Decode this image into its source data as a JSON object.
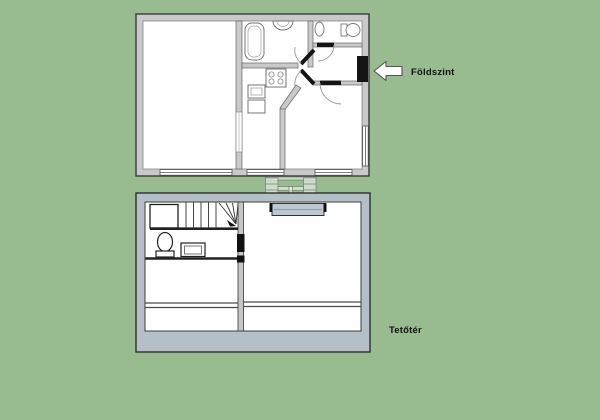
{
  "labels": {
    "ground_floor": "Földszint",
    "attic": "Tetőtér"
  },
  "colors": {
    "background": "#98BB90",
    "ground_wall_gray": "#C9C9C9",
    "attic_wall_blue_gray": "#B5BFC8",
    "interior_white": "#FFFFFF",
    "door_black": "#141414",
    "entrance_arrow": "#FFFFFF",
    "skylight_fill": "#BCC7D1",
    "label_text": "#111111"
  },
  "icons": {
    "entrance_arrow": "left-arrow",
    "between_floors": "ladder-railing",
    "stairs": "winder-staircase"
  }
}
